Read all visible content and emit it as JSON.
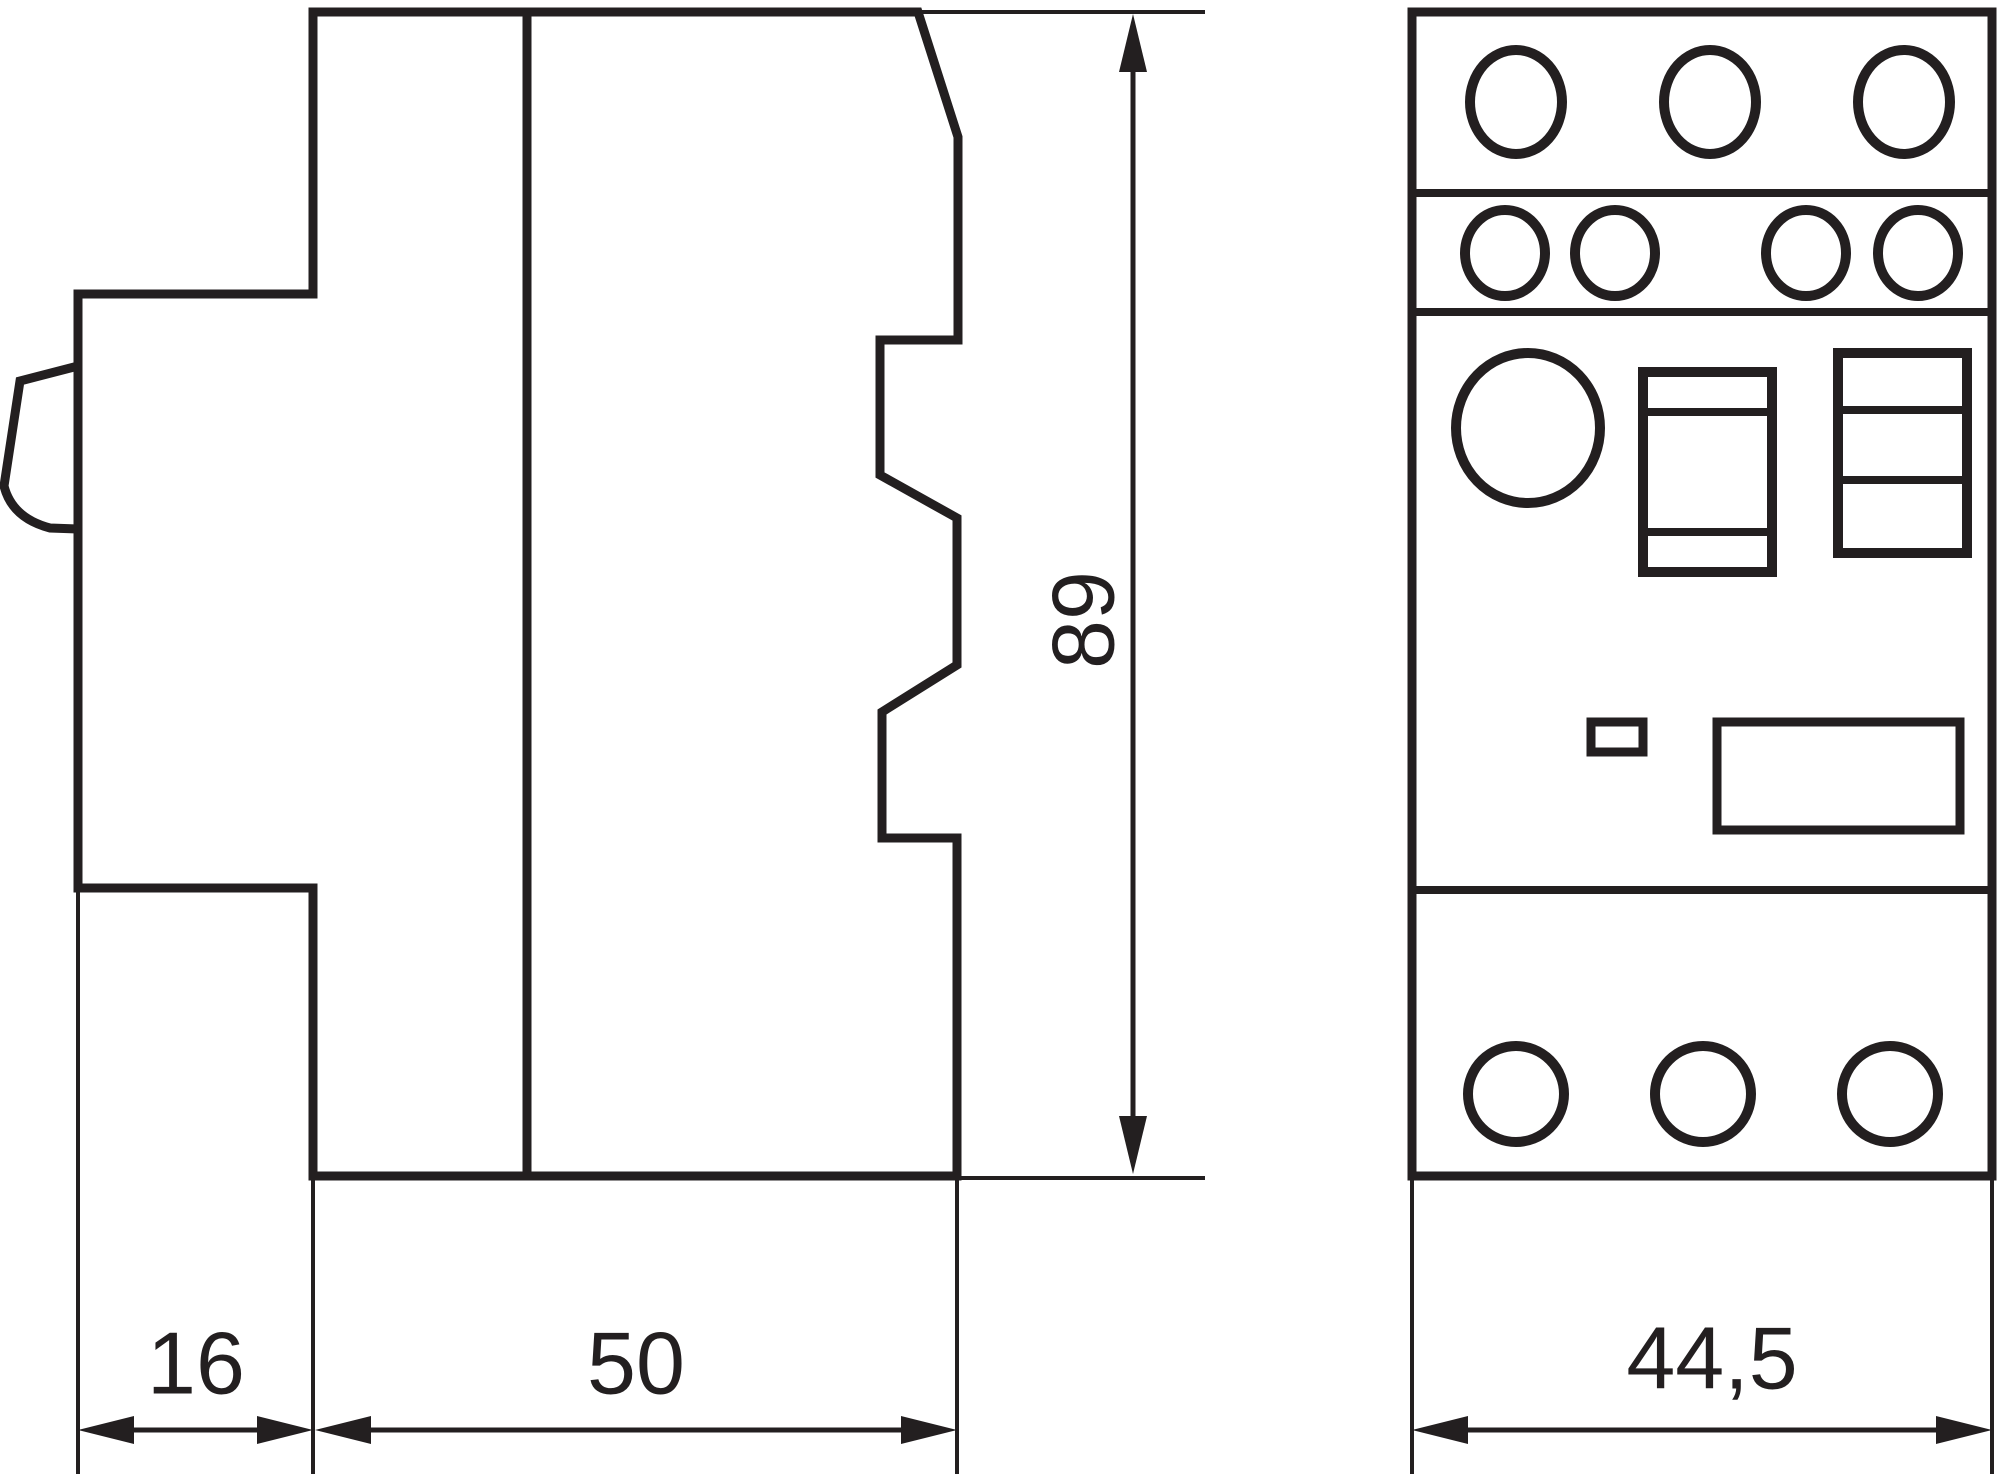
{
  "drawing": {
    "background_color": "#ffffff",
    "line_color": "#231f20",
    "side_view": {
      "dim_width_left": "16",
      "dim_width_right": "50",
      "dim_height": "89"
    },
    "front_view": {
      "dim_width": "44,5"
    }
  }
}
